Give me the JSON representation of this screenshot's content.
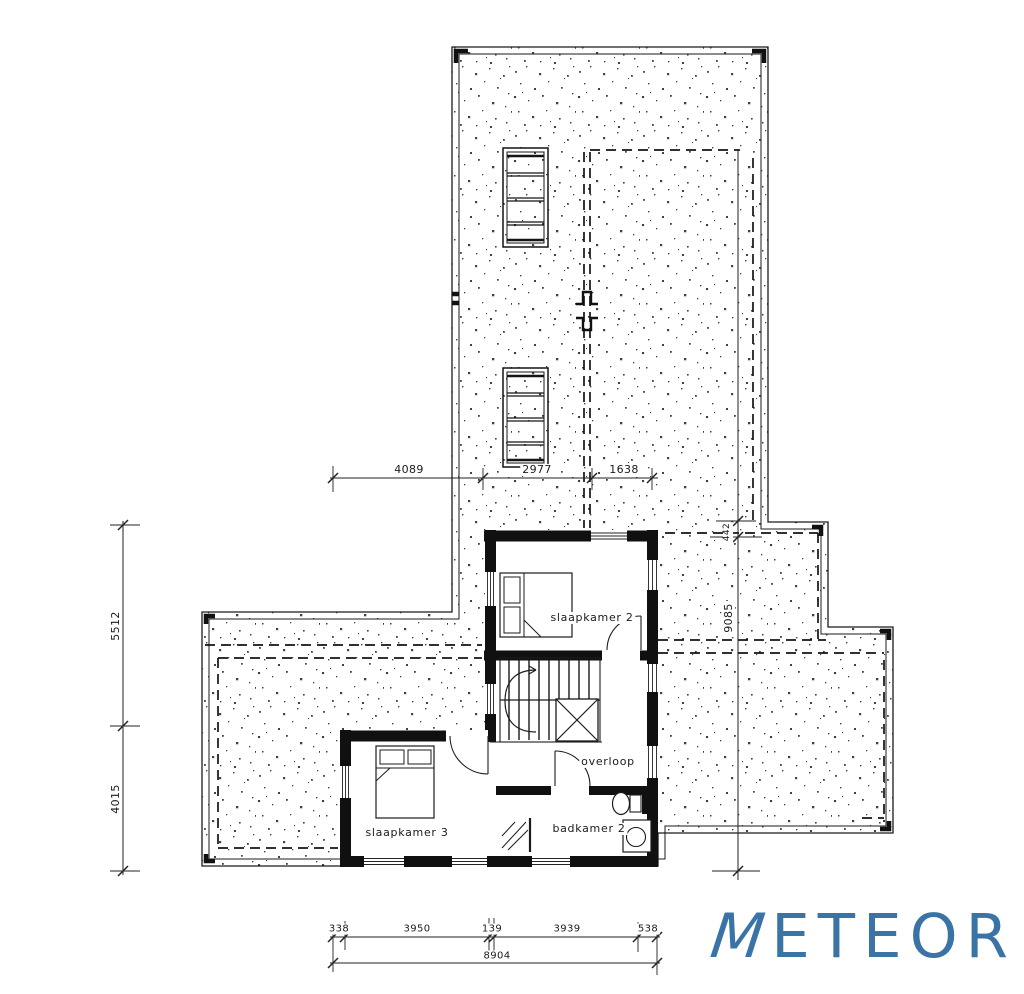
{
  "sheet": {
    "kind": "first floor plan (verdieping)",
    "background_color": "#ffffff",
    "line_color": "#1b1b1b"
  },
  "rooms": [
    {
      "label": "slaapkamer 2"
    },
    {
      "label": "overloop"
    },
    {
      "label": "slaapkamer 3"
    },
    {
      "label": "badkamer 2"
    }
  ],
  "dimensions": {
    "top": [
      "4089",
      "2977",
      "1638"
    ],
    "left": [
      "5512",
      "4015"
    ],
    "right": [
      "442",
      "9085"
    ],
    "bottom": [
      "338",
      "3950",
      "139",
      "3939",
      "538"
    ],
    "bottom_total": "8904"
  },
  "symbols": [
    "stair-with-void-icon",
    "bed-icon",
    "bed-icon",
    "toilet-icon",
    "sink-icon",
    "shower-icon",
    "door-swing-icon",
    "skylight-icon",
    "roof-stipple-texture",
    "dashed-roofline"
  ],
  "logo": {
    "m": "M",
    "rest": "ETEOR",
    "color": "#3a74a6"
  }
}
